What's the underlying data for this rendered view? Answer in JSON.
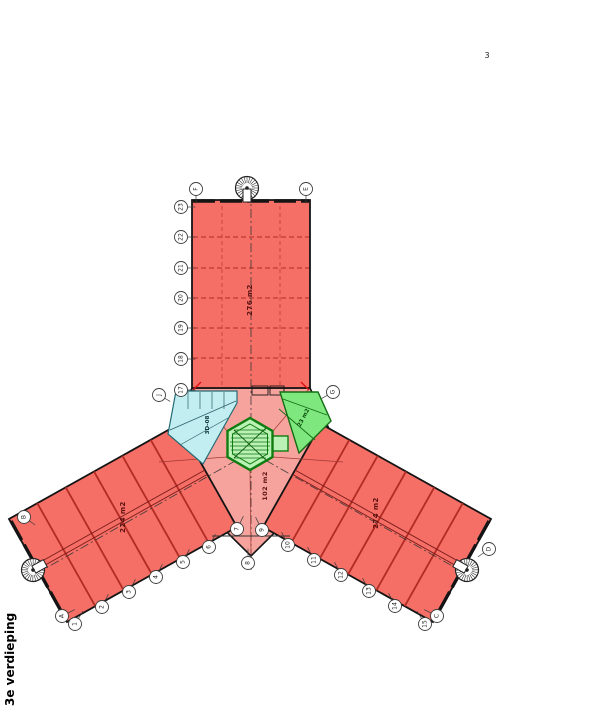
{
  "title": {
    "page_number": "3",
    "floor_label": "3e verdieping"
  },
  "plan": {
    "wings": [
      {
        "name": "north-wing",
        "area_label": "276 m2"
      },
      {
        "name": "west-wing",
        "area_label": "224 m2"
      },
      {
        "name": "east-wing",
        "area_label": "274 m2"
      }
    ],
    "central_court": {
      "area_label": "102 m2"
    },
    "rooms": [
      {
        "name": "sanitary-block",
        "area_label": "3D-08"
      },
      {
        "name": "green-room",
        "area_label": "23 m2"
      }
    ],
    "colors": {
      "wing_fill": "#f56f66",
      "court_fill": "#f7a39d",
      "sanitary_fill": "#c2eef2",
      "room_green_fill": "#7ee87e",
      "stair_core_fill": "#b9f2b4",
      "stair_core_stroke": "#0f7d0f",
      "outline": "#141414",
      "bay_line": "#b32c24"
    }
  },
  "grid_bubbles": [
    {
      "label": "F",
      "x": 196,
      "y": 189,
      "tick": [
        0,
        9
      ]
    },
    {
      "label": "E",
      "x": 306,
      "y": 189,
      "tick": [
        0,
        9
      ]
    },
    {
      "label": "23",
      "x": 181,
      "y": 207,
      "tick": [
        9,
        0
      ]
    },
    {
      "label": "22",
      "x": 181,
      "y": 237,
      "tick": [
        9,
        0
      ]
    },
    {
      "label": "21",
      "x": 181,
      "y": 268,
      "tick": [
        9,
        0
      ]
    },
    {
      "label": "20",
      "x": 181,
      "y": 298,
      "tick": [
        9,
        0
      ]
    },
    {
      "label": "19",
      "x": 181,
      "y": 328,
      "tick": [
        9,
        0
      ]
    },
    {
      "label": "18",
      "x": 181,
      "y": 359,
      "tick": [
        9,
        0
      ]
    },
    {
      "label": "17",
      "x": 181,
      "y": 390,
      "tick": [
        9,
        0
      ]
    },
    {
      "label": "J",
      "x": 159,
      "y": 395,
      "tick": [
        7,
        4
      ]
    },
    {
      "label": "G",
      "x": 333,
      "y": 392,
      "tick": [
        -7,
        4
      ]
    },
    {
      "label": "B",
      "x": 24,
      "y": 517,
      "tick": [
        7,
        5
      ]
    },
    {
      "label": "D",
      "x": 489,
      "y": 549,
      "tick": [
        -7,
        5
      ]
    },
    {
      "label": "A",
      "x": 62,
      "y": 616,
      "tick": [
        8,
        -4
      ]
    },
    {
      "label": "1",
      "x": 75,
      "y": 624,
      "tick": [
        5,
        -8
      ]
    },
    {
      "label": "2",
      "x": 102,
      "y": 607,
      "tick": [
        4,
        -8
      ]
    },
    {
      "label": "3",
      "x": 129,
      "y": 592,
      "tick": [
        4,
        -8
      ]
    },
    {
      "label": "4",
      "x": 156,
      "y": 577,
      "tick": [
        4,
        -8
      ]
    },
    {
      "label": "5",
      "x": 183,
      "y": 562,
      "tick": [
        4,
        -8
      ]
    },
    {
      "label": "6",
      "x": 209,
      "y": 547,
      "tick": [
        4,
        -8
      ]
    },
    {
      "label": "7",
      "x": 237,
      "y": 529,
      "tick": [
        4,
        -8
      ]
    },
    {
      "label": "8",
      "x": 248,
      "y": 563,
      "tick": [
        0,
        -9
      ]
    },
    {
      "label": "9",
      "x": 262,
      "y": 530,
      "tick": [
        -4,
        -8
      ]
    },
    {
      "label": "10",
      "x": 288,
      "y": 545,
      "tick": [
        -4,
        -8
      ]
    },
    {
      "label": "11",
      "x": 314,
      "y": 560,
      "tick": [
        -4,
        -8
      ]
    },
    {
      "label": "12",
      "x": 341,
      "y": 575,
      "tick": [
        -4,
        -8
      ]
    },
    {
      "label": "13",
      "x": 369,
      "y": 591,
      "tick": [
        -4,
        -8
      ]
    },
    {
      "label": "14",
      "x": 395,
      "y": 606,
      "tick": [
        -4,
        -8
      ]
    },
    {
      "label": "15",
      "x": 425,
      "y": 624,
      "tick": [
        -5,
        -8
      ]
    },
    {
      "label": "C",
      "x": 437,
      "y": 616,
      "tick": [
        -8,
        -4
      ]
    }
  ]
}
